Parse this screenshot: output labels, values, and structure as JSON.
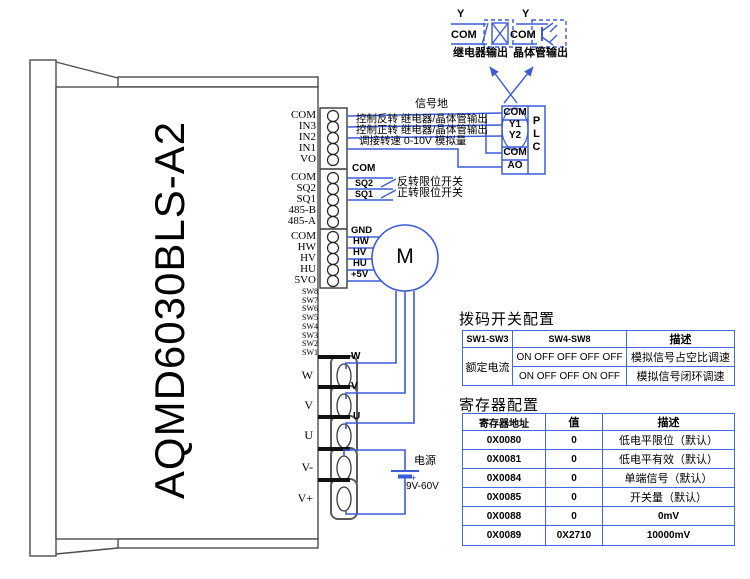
{
  "device": {
    "model": "AQMD6030BLS-A2"
  },
  "colors": {
    "wire_blue": "#3b5cd9",
    "table_border": "#4169e1",
    "outline_gray": "#4d4d4d"
  },
  "pins": [
    "COM",
    "IN3",
    "IN2",
    "IN1",
    "VO",
    "COM",
    "SQ2",
    "SQ1",
    "485-B",
    "485-A",
    "COM",
    "HW",
    "HV",
    "HU",
    "5VO"
  ],
  "dip_pins": [
    "SW8",
    "SW7",
    "SW6",
    "SW5",
    "SW4",
    "SW3",
    "SW2",
    "SW1"
  ],
  "signals": {
    "ground": "信号地",
    "reverse": "控制反转  继电器/晶体管输出",
    "forward": "控制正转  继电器/晶体管输出",
    "speed": "调接转速  0-10V  模拟量"
  },
  "limit": {
    "com": "COM",
    "sq2": "SQ2",
    "sq1": "SQ1",
    "reverse_desc": "反转限位开关",
    "forward_desc": "正转限位开关"
  },
  "hall": [
    "GND",
    "HW",
    "HV",
    "HU",
    "+5V"
  ],
  "motor": {
    "label": "M"
  },
  "phases": [
    "W",
    "V",
    "U"
  ],
  "terminals": [
    "W",
    "V",
    "U",
    "V-",
    "V+"
  ],
  "power": {
    "name": "电源",
    "range": "9V-60V",
    "plus": "+"
  },
  "outputs": {
    "relay": {
      "y": "Y",
      "com": "COM",
      "label": "继电器输出"
    },
    "transistor": {
      "y": "Y",
      "com": "COM",
      "label": "晶体管输出"
    }
  },
  "plc": {
    "cells": [
      "COM",
      "Y1",
      "Y2",
      "COM",
      "AO"
    ],
    "name": [
      "P",
      "L",
      "C"
    ]
  },
  "dip_table": {
    "title": "拨码开关配置",
    "headers": [
      "SW1-SW3",
      "SW4-SW8",
      "描述"
    ],
    "col1_merged": "额定电流",
    "rows": [
      {
        "sw": "ON OFF OFF OFF OFF",
        "desc": "模拟信号占空比调速"
      },
      {
        "sw": "ON OFF OFF ON  OFF",
        "desc": "模拟信号闭环调速"
      }
    ]
  },
  "reg_table": {
    "title": "寄存器配置",
    "headers": [
      "寄存器地址",
      "值",
      "描述"
    ],
    "rows": [
      {
        "addr": "0X0080",
        "val": "0",
        "desc": "低电平限位（默认）"
      },
      {
        "addr": "0X0081",
        "val": "0",
        "desc": "低电平有效（默认）"
      },
      {
        "addr": "0X0084",
        "val": "0",
        "desc": "单端信号（默认）"
      },
      {
        "addr": "0X0085",
        "val": "0",
        "desc": "开关量（默认）"
      },
      {
        "addr": "0X0088",
        "val": "0",
        "desc": "0mV"
      },
      {
        "addr": "0X0089",
        "val": "0X2710",
        "desc": "10000mV"
      }
    ]
  }
}
